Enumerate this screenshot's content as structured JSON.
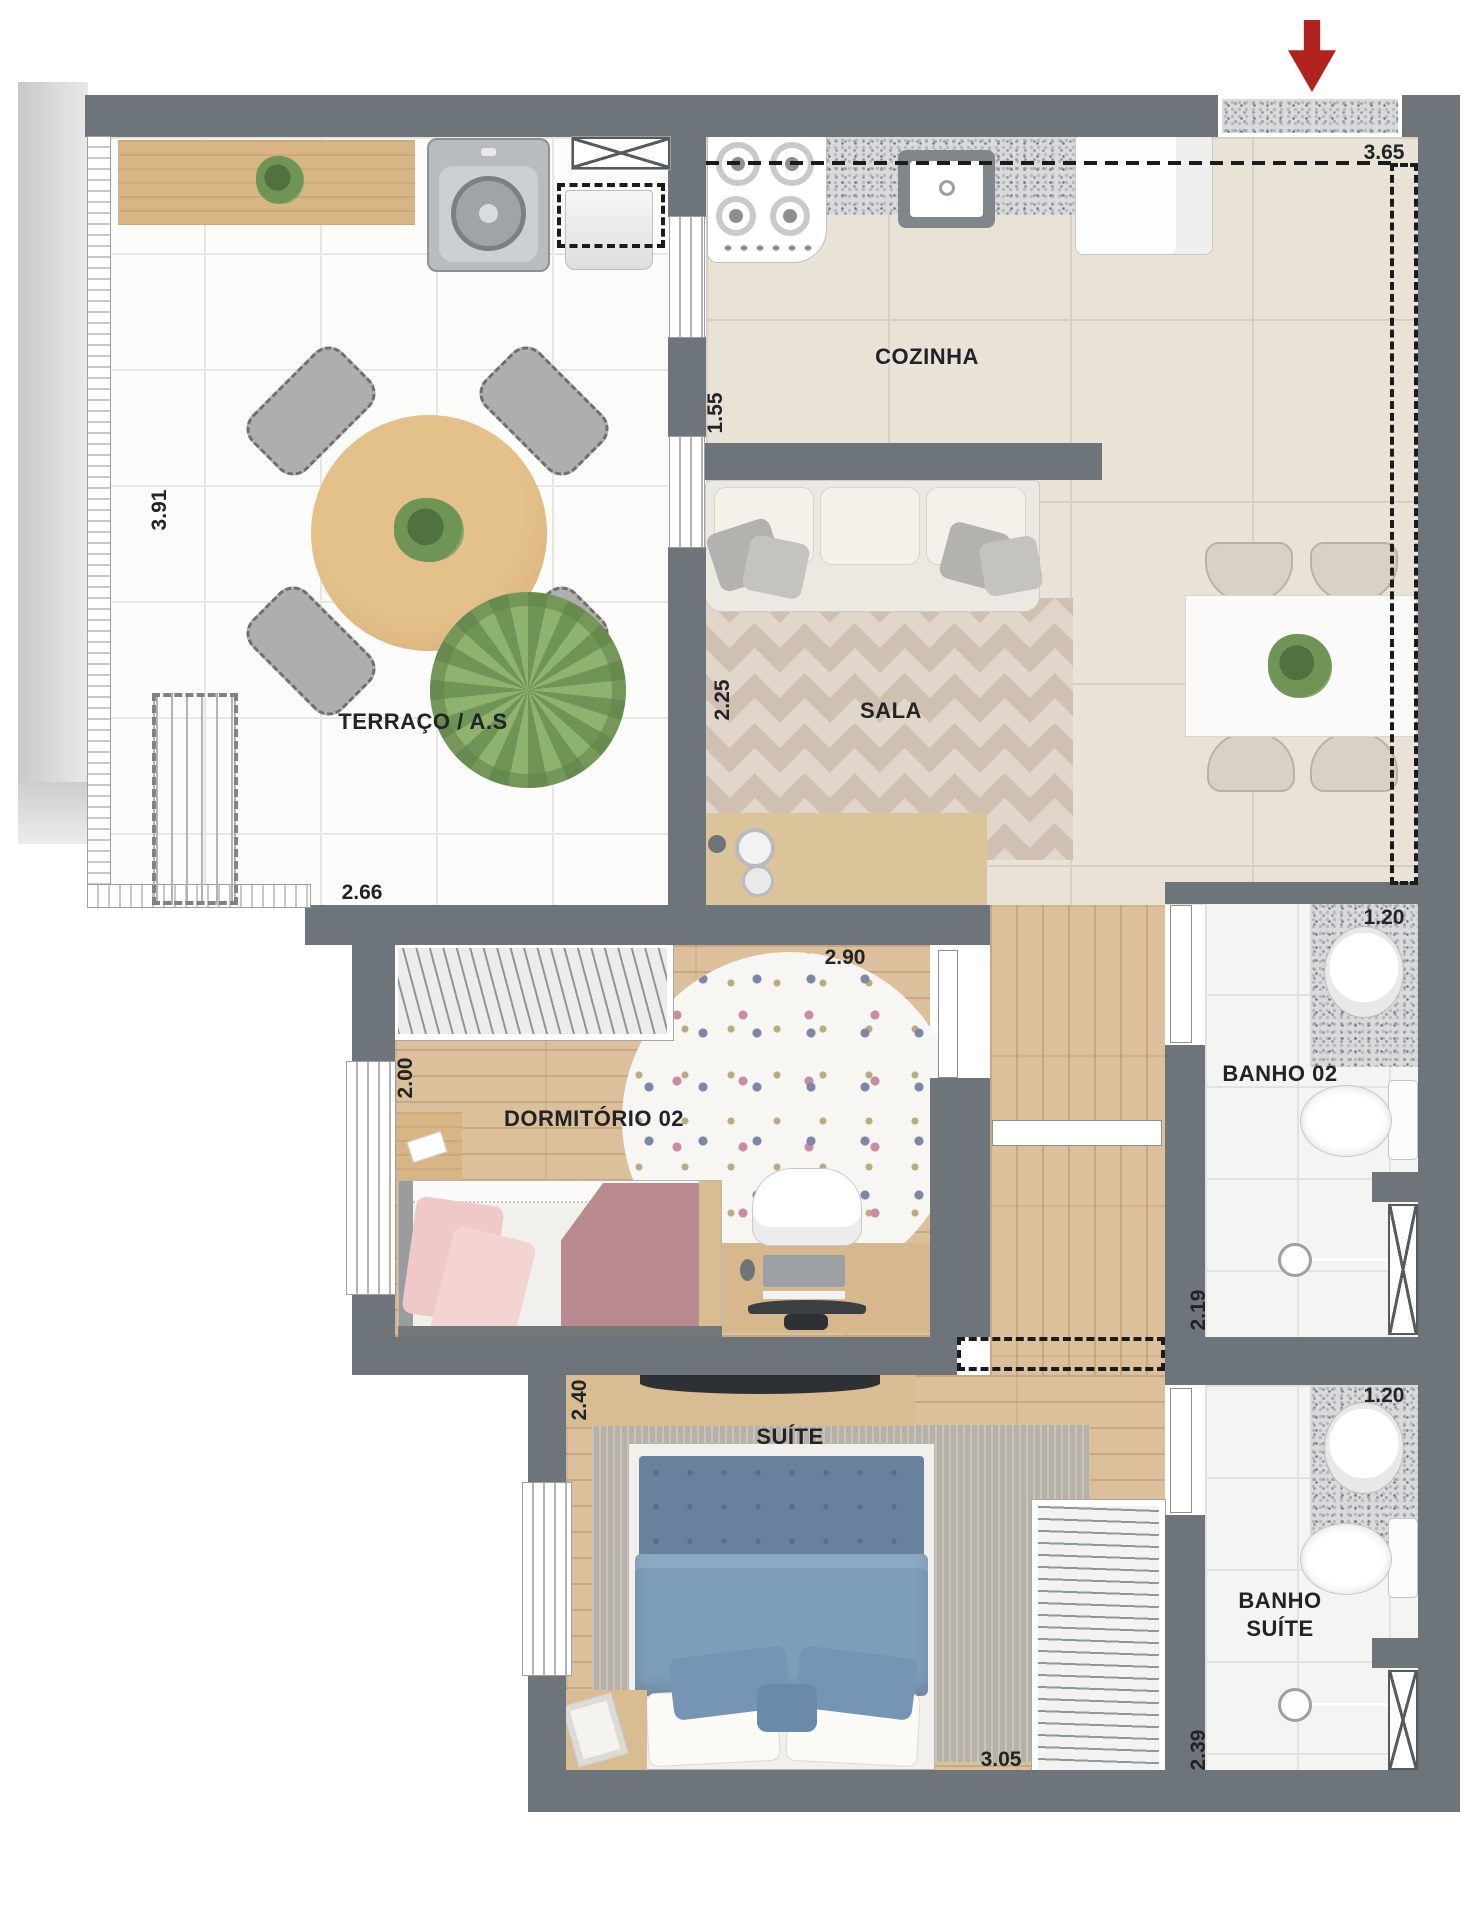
{
  "meta": {
    "type": "apartment floor plan",
    "language": "pt-BR",
    "style": "top-down rendered furniture plan"
  },
  "labels": {
    "terraco": "TERRAÇO / A.S",
    "cozinha": "COZINHA",
    "sala": "SALA",
    "dormitorio02": "DORMITÓRIO 02",
    "banho02": "BANHO 02",
    "suite": "SUÍTE",
    "banho_suite_l1": "BANHO",
    "banho_suite_l2": "SUÍTE"
  },
  "dimensions": {
    "cozinha_width": "3.65",
    "cozinha_opening": "1.55",
    "terraco_depth": "3.91",
    "sala_opening": "2.25",
    "terraco_width": "2.66",
    "dorm02_width": "2.90",
    "dorm02_depth": "2.00",
    "banho02_width": "1.20",
    "banho02_depth": "2.19",
    "suite_depth": "2.40",
    "suite_width": "3.05",
    "banho_suite_width": "1.20",
    "banho_suite_depth": "2.39"
  },
  "entrance": {
    "indicator": "red-arrow-down",
    "arrow_color": "#b3231e"
  },
  "colors": {
    "wall": "#6d747a",
    "wood_floor": "#dcc09c",
    "beige_tile": "#e9e2d7",
    "suite_bed_blue": "#7e9dba",
    "dorm_blanket_mauve": "#b98a90",
    "dorm_pillow_pink": "#eec9c8"
  },
  "furniture": {
    "terrace": [
      "wood-bench",
      "potted-plant",
      "washing-machine",
      "laundry-tank",
      "round-dining-table",
      "terrace-chairs",
      "clothes-rack",
      "palm-plant"
    ],
    "kitchen": [
      "stove",
      "kitchen-sink",
      "countertop",
      "refrigerator"
    ],
    "living": [
      "sofa",
      "chevron-rug",
      "sideboard",
      "dining-table",
      "dining-chairs",
      "table-plant"
    ],
    "bedroom02": [
      "wardrobe",
      "nightstand",
      "single-bed",
      "polka-rug",
      "desk",
      "desk-chair",
      "monitor"
    ],
    "suite": [
      "tv-console",
      "tv",
      "double-bed",
      "rug",
      "nightstand",
      "book",
      "wardrobe"
    ],
    "bath02": [
      "vanity-sink",
      "toilet",
      "shower-box",
      "shower-drain",
      "door"
    ],
    "bath_suite": [
      "vanity-sink",
      "toilet",
      "shower-box",
      "shower-drain",
      "door"
    ]
  }
}
